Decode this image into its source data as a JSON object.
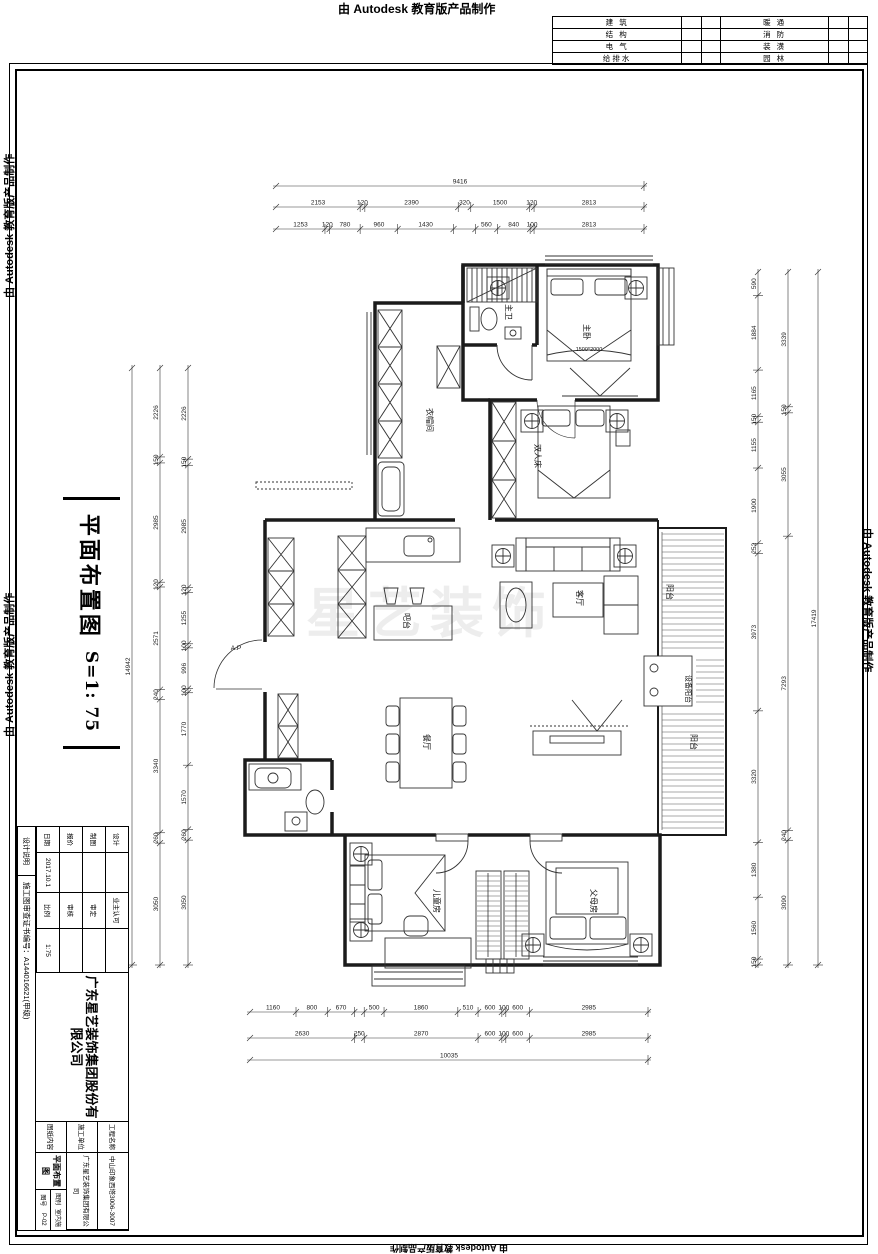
{
  "stamp": {
    "text": "由 Autodesk 教育版产品制作"
  },
  "discipline": {
    "rows": [
      {
        "l": "建 筑",
        "r": "暖 通"
      },
      {
        "l": "结 构",
        "r": "消 防"
      },
      {
        "l": "电 气",
        "r": "装 潢"
      },
      {
        "l": "给排水",
        "r": "园 林"
      }
    ]
  },
  "sheet_title": {
    "name": "平面布置图",
    "scale": "S=1: 75"
  },
  "title_block": {
    "company": "广东星艺装饰集团股份有限公司",
    "fields": [
      {
        "label": "设计",
        "value": ""
      },
      {
        "label": "制图",
        "value": ""
      },
      {
        "label": "报价",
        "value": ""
      },
      {
        "label": "日期",
        "value": "2017.10.1"
      },
      {
        "label": "业主认可",
        "value": ""
      },
      {
        "label": "审定",
        "value": ""
      },
      {
        "label": "审核",
        "value": ""
      },
      {
        "label": "比例",
        "value": "1:75"
      }
    ],
    "project_label": "工程名称",
    "project": "中山印象西塔3006-3007",
    "contractor_label": "施工单位",
    "contractor": "广东星艺装饰集团有限公司",
    "content_label": "图纸内容",
    "content": "平面布置图",
    "type_label": "图别",
    "type": "室内施",
    "no_label": "图号",
    "no": "P-02",
    "note": "设计说明",
    "cert": "施工图审查证书编号：A144016621(甲级)"
  },
  "plan": {
    "watermark": "星艺装饰",
    "labels": [
      {
        "t": "主卫",
        "x": 506,
        "y": 312,
        "r": 90,
        "s": 8
      },
      {
        "t": "主卧",
        "x": 584,
        "y": 332,
        "r": 90,
        "s": 8
      },
      {
        "t": "1500*2000",
        "x": 589,
        "y": 351,
        "r": 0,
        "s": 5.5
      },
      {
        "t": "衣帽间",
        "x": 427,
        "y": 420,
        "r": 90,
        "s": 8
      },
      {
        "t": "双人床",
        "x": 535,
        "y": 456,
        "r": 90,
        "s": 8
      },
      {
        "t": "客厅",
        "x": 577,
        "y": 598,
        "r": 90,
        "s": 8
      },
      {
        "t": "吧台",
        "x": 404,
        "y": 621,
        "r": 90,
        "s": 8
      },
      {
        "t": "餐厅",
        "x": 424,
        "y": 742,
        "r": 90,
        "s": 8
      },
      {
        "t": "阳台",
        "x": 667,
        "y": 592,
        "r": 90,
        "s": 8
      },
      {
        "t": "设备阳台",
        "x": 686,
        "y": 689,
        "r": 90,
        "s": 7
      },
      {
        "t": "阳台",
        "x": 691,
        "y": 742,
        "r": 90,
        "s": 8
      },
      {
        "t": "儿童房",
        "x": 434,
        "y": 901,
        "r": 90,
        "s": 8
      },
      {
        "t": "父母房",
        "x": 591,
        "y": 901,
        "r": 90,
        "s": 8
      },
      {
        "t": "A.P",
        "x": 236,
        "y": 650,
        "r": 0,
        "s": 6.5
      }
    ]
  },
  "dims": {
    "chains": [
      {
        "dir": "h",
        "line": 186,
        "a": 276,
        "b": 644,
        "vals": [
          "9416"
        ]
      },
      {
        "dir": "h",
        "line": 207,
        "a": 276,
        "b": 644,
        "vals": [
          "2153",
          "120",
          "2390",
          "320",
          "1500",
          "120",
          "2813"
        ]
      },
      {
        "dir": "h",
        "line": 229,
        "a": 276,
        "b": 644,
        "vals": [
          "1253",
          "120",
          "780",
          "960",
          "1430",
          "~560",
          "560",
          "840",
          "100",
          "2813"
        ]
      },
      {
        "dir": "h",
        "line": 1012,
        "a": 250,
        "b": 648,
        "vals": [
          "1160",
          "800",
          "670",
          "~250",
          "500",
          "1860",
          "510",
          "600",
          "100",
          "600",
          "2985"
        ]
      },
      {
        "dir": "h",
        "line": 1038,
        "a": 250,
        "b": 648,
        "vals": [
          "2630",
          "250",
          "2870",
          "600",
          "100",
          "600",
          "2985"
        ]
      },
      {
        "dir": "h",
        "line": 1060,
        "a": 250,
        "b": 648,
        "vals": [
          "10035"
        ]
      },
      {
        "dir": "v",
        "line": 188,
        "a": 368,
        "b": 965,
        "vals": [
          "2226",
          "150",
          "2985",
          "120",
          "1255",
          "100",
          "996",
          "100",
          "1770",
          "1570",
          "260",
          "3050"
        ]
      },
      {
        "dir": "v",
        "line": 160,
        "a": 368,
        "b": 965,
        "vals": [
          "2226",
          "150",
          "2985",
          "120",
          "2571",
          "240",
          "3340",
          "260",
          "3050"
        ]
      },
      {
        "dir": "v",
        "line": 132,
        "a": 368,
        "b": 965,
        "vals": [
          "14942"
        ]
      },
      {
        "dir": "v",
        "line": 758,
        "a": 272,
        "b": 965,
        "vals": [
          "590",
          "1884",
          "1165",
          "150",
          "1155",
          "1900",
          "252",
          "3973",
          "3320",
          "1380",
          "1560",
          "150"
        ]
      },
      {
        "dir": "v",
        "line": 788,
        "a": 272,
        "b": 965,
        "vals": [
          "3339",
          "150",
          "3055",
          "7293",
          "240",
          "3090"
        ]
      },
      {
        "dir": "v",
        "line": 818,
        "a": 272,
        "b": 965,
        "vals": [
          "17419"
        ]
      }
    ]
  }
}
